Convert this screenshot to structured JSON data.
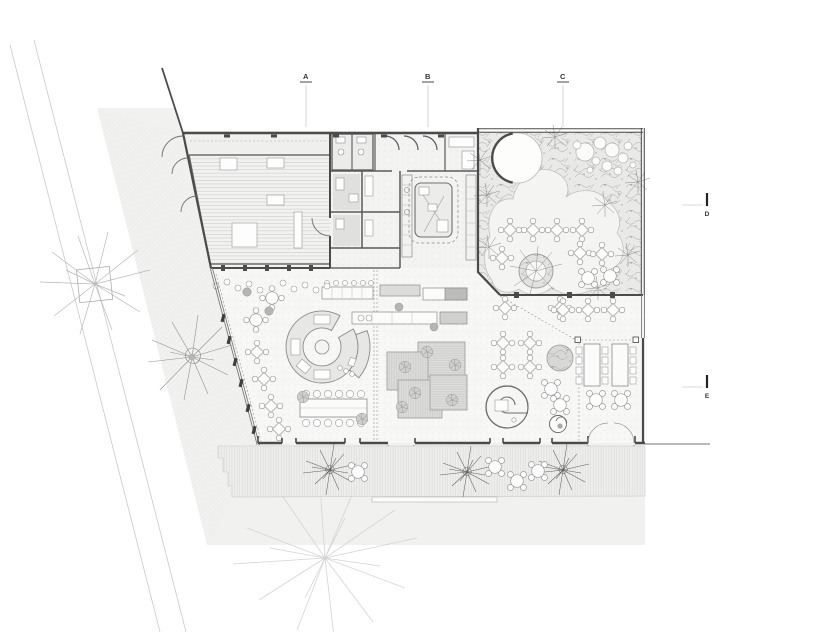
{
  "drawing": {
    "kind": "architectural ground floor plan"
  },
  "markers": {
    "top": [
      {
        "label": "A"
      },
      {
        "label": "B"
      },
      {
        "label": "C"
      }
    ],
    "right": [
      {
        "label": "D"
      },
      {
        "label": "E"
      }
    ]
  },
  "palette": {
    "wall": "#4b4b4b",
    "site_ground": "#f1f1f0",
    "terrace": "#eeeeec",
    "deck_platform": "#dcdcdb",
    "planting_scribble": "#9e9e9d",
    "patio": "#f4f4f2",
    "faint_tree": "#d4d4d3",
    "label_text": "#333333"
  }
}
